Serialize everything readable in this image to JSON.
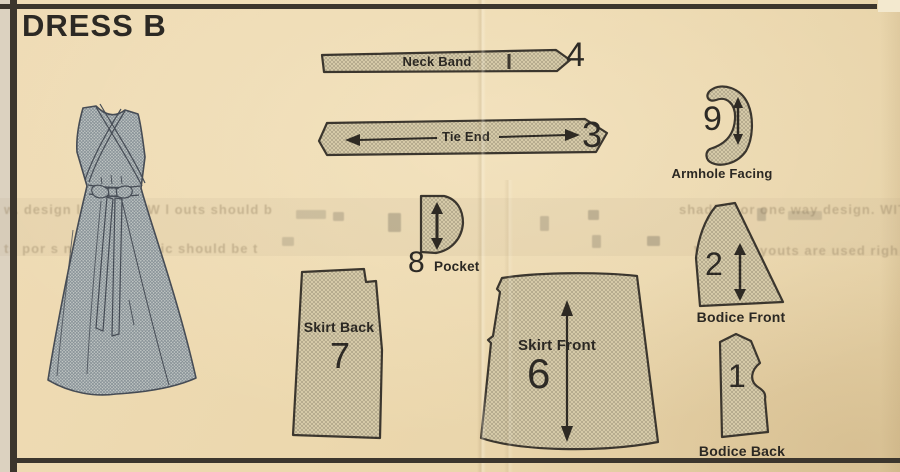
{
  "page": {
    "title": "DRESS B"
  },
  "pieces": {
    "neck_band": {
      "num": "4",
      "label": "Neck Band"
    },
    "tie_end": {
      "num": "3",
      "label": "Tie End"
    },
    "armhole_facing": {
      "num": "9",
      "label": "Armhole Facing"
    },
    "pocket": {
      "num": "8",
      "label": "Pocket"
    },
    "skirt_back": {
      "num": "7",
      "label": "Skirt Back"
    },
    "skirt_front": {
      "num": "6",
      "label": "Skirt Front"
    },
    "bodice_front": {
      "num": "2",
      "label": "Bodice Front"
    },
    "bodice_back": {
      "num": "1",
      "label": "Bodice Back"
    }
  },
  "ghost_text": {
    "left_line1": "w. design  la  OUE YAW  l outs should b",
    "left_line2": "ts  por  s  nl  nno  of fabric should be t",
    "right_line1": "shading or one way design. WITH",
    "right_line2": "Whe  F  l  ayouts are used  righ"
  },
  "colors": {
    "paper": "#ecd8ae",
    "ink": "#2b2823",
    "piece_fill": "#dbcfad",
    "dress_fill": "#c6cbc8"
  }
}
